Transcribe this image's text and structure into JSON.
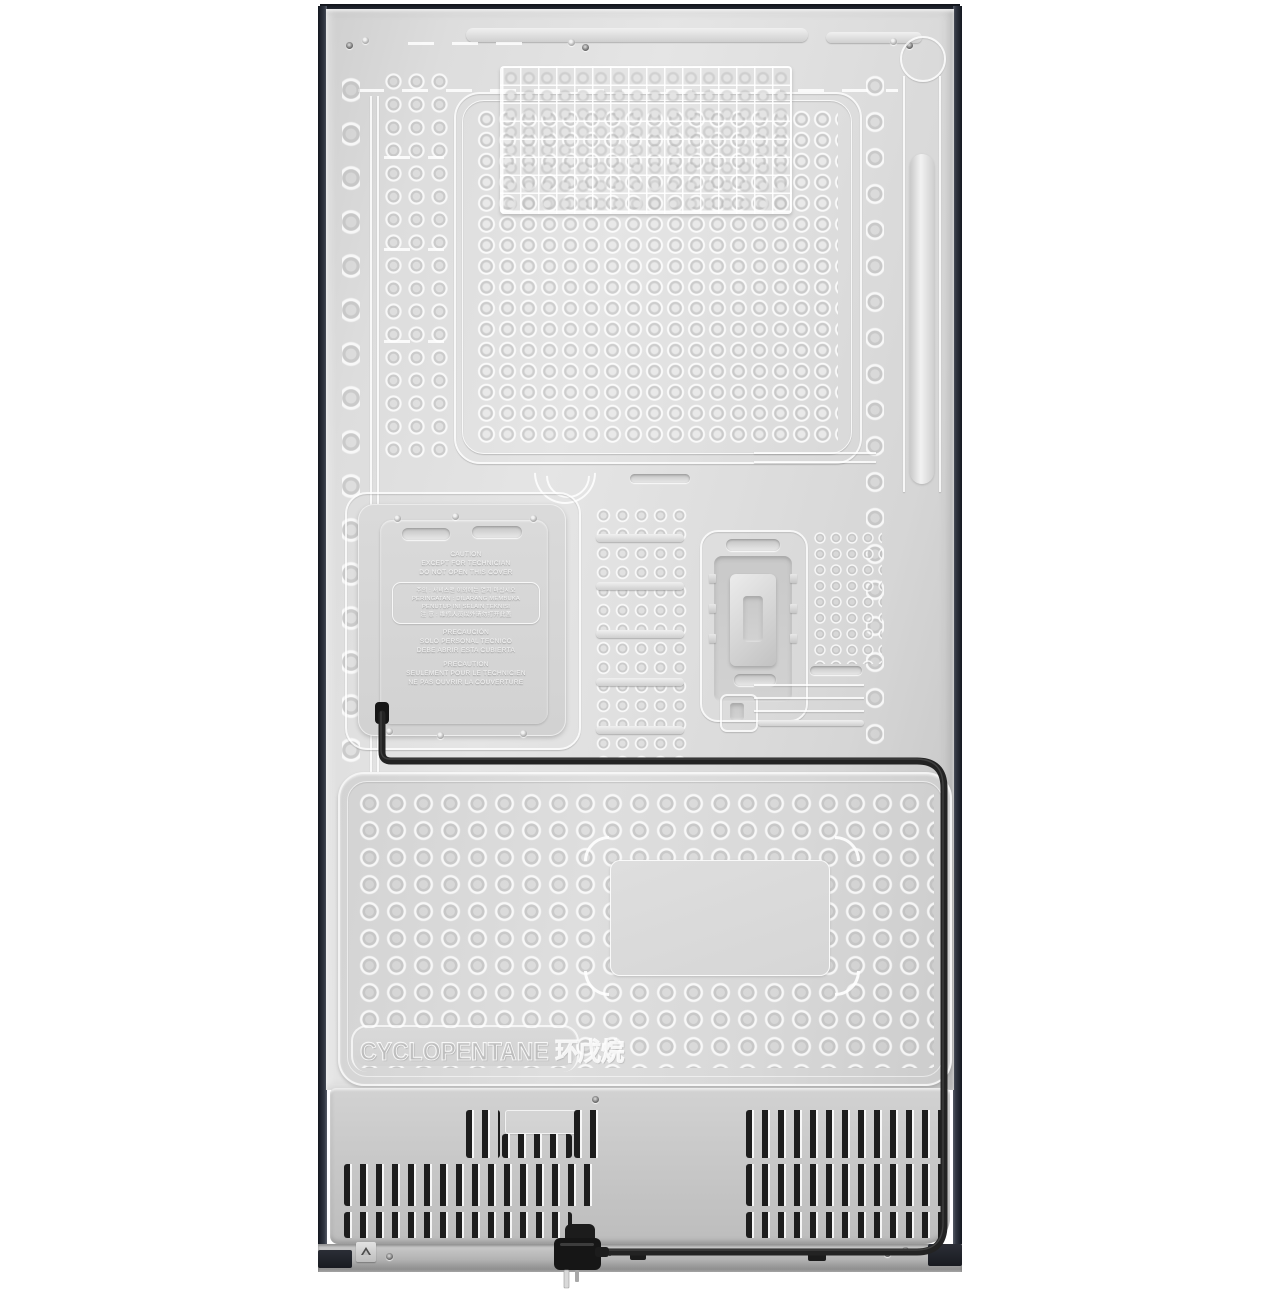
{
  "scene": {
    "type": "product-photo",
    "subject": "rear view of a refrigerator cabinet",
    "background": "#ffffff"
  },
  "panel_text": {
    "blowing_agent": "CYCLOPENTANE 环戊烷"
  },
  "caution_label": {
    "en": [
      "CAUTION",
      "EXCEPT FOR TECHNICIAN",
      "DO NOT OPEN THIS COVER"
    ],
    "boxed": [
      "주의 : 서비스맨 이외에는 열지 마십시오",
      "PERINGATAN : DILARANG MEMBUKA",
      "PENUTUP INI SELAIN TEKNISI",
      "注 意 : 维修人员以外请勿打开此盖"
    ],
    "es": [
      "PRECAUCIÓN",
      "SOLO PERSONAL TECNICO",
      "DEBE ABRIR ESTA CUBIERTA"
    ],
    "fr": [
      "PRECAUTION",
      "SEULEMENT POUR LE TECHNICIEN",
      "NE PAS OUVRIR LA COUVERTURE"
    ]
  },
  "colors": {
    "panel_base": "#dcdcdc",
    "panel_highlight": "#e9e9e9",
    "panel_shadow": "#c2c2c2",
    "cabinet_edge_dark": "#1c2029",
    "compressor_cover": "#c6c6c6",
    "vent_slot": "#1d1d1d",
    "power_cable": "#232323",
    "bottom_rail": "#a8a8a8",
    "background": "#ffffff"
  }
}
